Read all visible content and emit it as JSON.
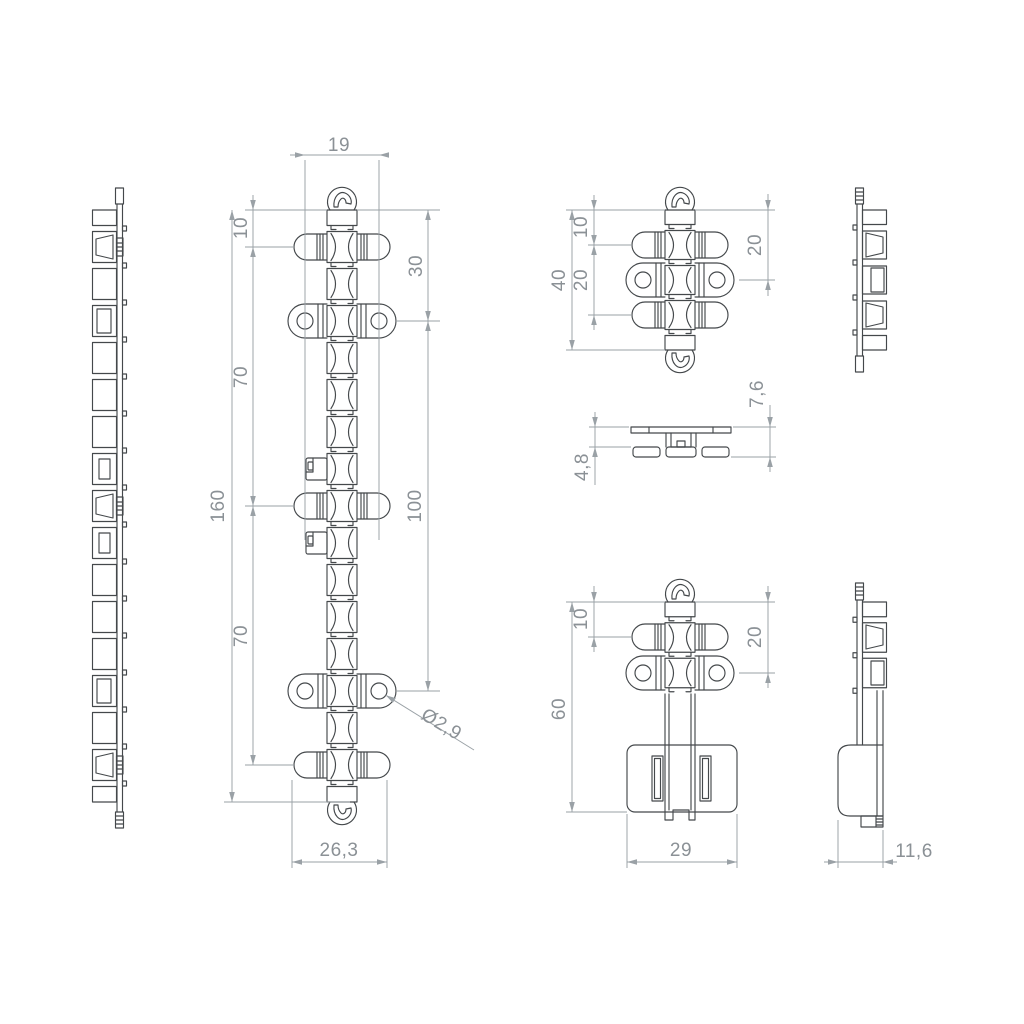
{
  "colors": {
    "background": "#ffffff",
    "part_line": "#44484b",
    "dim_line": "#9aa1a6",
    "dim_text": "#8b9196"
  },
  "views": {
    "front_160": {
      "dims": {
        "hole_span": "19",
        "top_to_first_pin": "10",
        "upper_pin_pitch": "70",
        "overall_length": "160",
        "lower_pin_pitch": "70",
        "top_to_first_hole": "30",
        "hole_pitch": "100",
        "base_width": "26,3",
        "hole_diameter": "Ø2,9"
      }
    },
    "front_40": {
      "dims": {
        "overall_length": "40",
        "top_to_pin": "10",
        "pin_pitch": "20",
        "top_to_hole": "20"
      }
    },
    "top_section": {
      "dims": {
        "overall_height": "7,6",
        "body_height": "4,8"
      }
    },
    "front_60": {
      "dims": {
        "overall_length": "60",
        "top_to_pin": "10",
        "top_to_hole": "20",
        "base_width": "29"
      }
    },
    "side_60": {
      "dims": {
        "base_depth": "11,6"
      }
    }
  }
}
